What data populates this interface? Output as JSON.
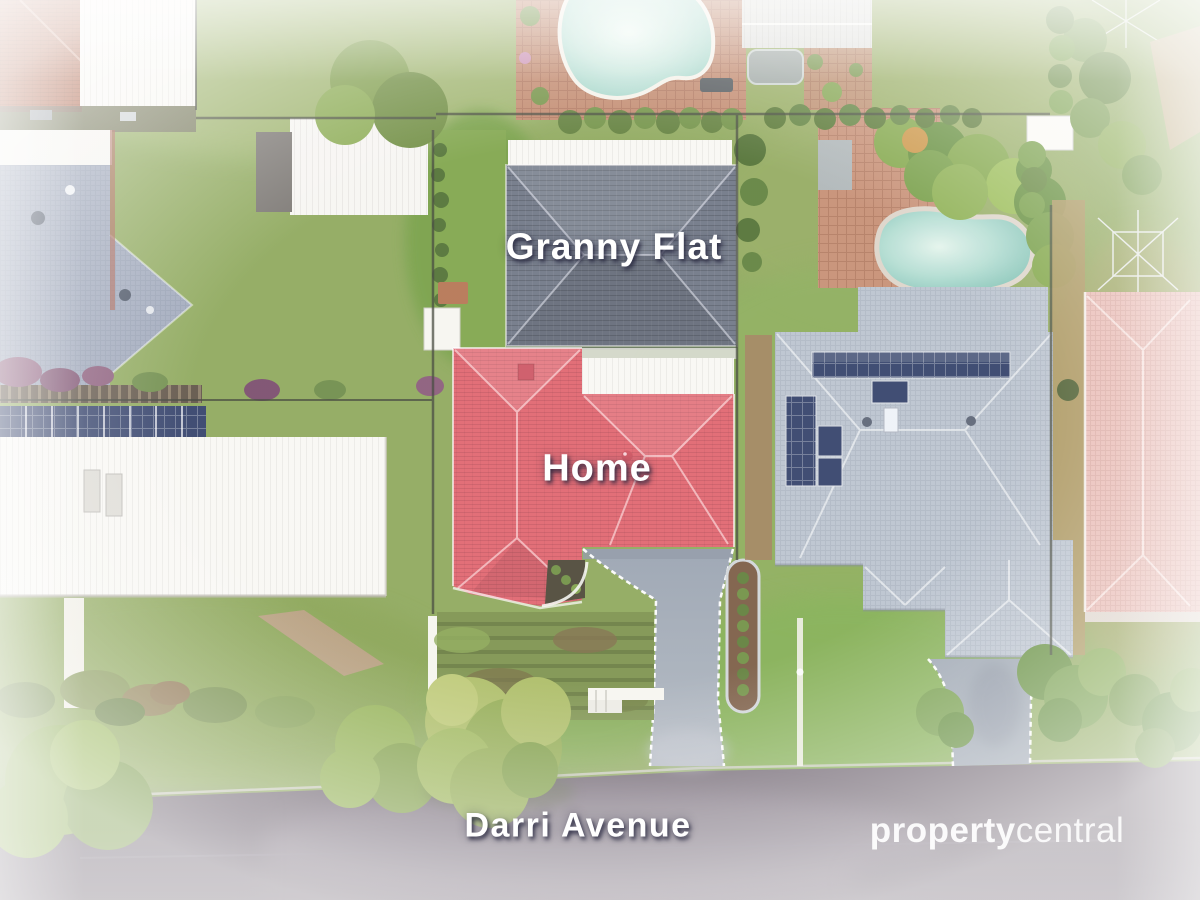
{
  "annotations": {
    "granny_flat": "Granny Flat",
    "home": "Home",
    "street": "Darri Avenue"
  },
  "watermark": {
    "bold": "property",
    "light": "central"
  },
  "colors": {
    "home_roof": "#e2606b",
    "granny_flat_roof": "#6d7484",
    "right_house_roof": "#b6bfcb",
    "left_house_roof": "#9aa4b8",
    "pink_house_roof": "#e6b6ae",
    "terracotta_roof": "#b2684e",
    "white_roof": "#f3f2ee",
    "lawn": "#8aa656",
    "lawn_dark": "#6f9a40",
    "road": "#6b5f6c",
    "driveway": "#9aa3b0",
    "solar_panel": "#32406b",
    "pool_water": "#a8d8cd",
    "brick_paving": "#c08468",
    "label_text": "#ffffff"
  }
}
